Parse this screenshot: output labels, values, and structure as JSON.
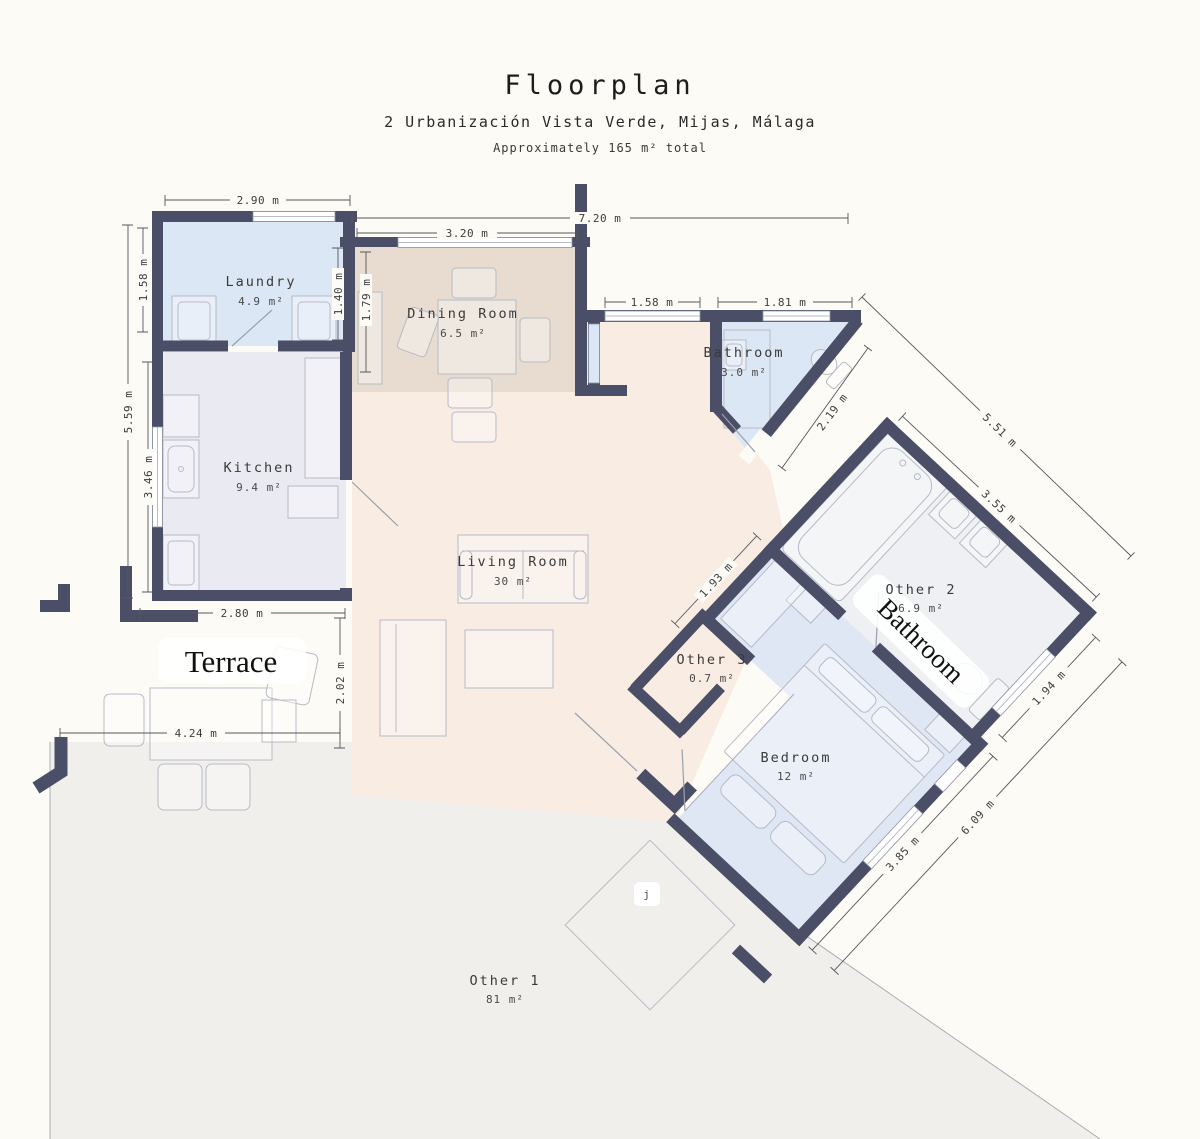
{
  "header": {
    "title": "Floorplan",
    "subtitle": "2 Urbanización Vista Verde, Mijas, Málaga",
    "note": "Approximately 165 m² total"
  },
  "rooms": {
    "laundry": {
      "name": "Laundry",
      "area": "4.9 m²"
    },
    "dining": {
      "name": "Dining Room",
      "area": "6.5 m²"
    },
    "kitchen": {
      "name": "Kitchen",
      "area": "9.4 m²"
    },
    "bathroom": {
      "name": "Bathroom",
      "area": "3.0 m²"
    },
    "living": {
      "name": "Living Room",
      "area": "30 m²"
    },
    "other2": {
      "name": "Other 2",
      "area": "6.9 m²"
    },
    "other3": {
      "name": "Other 3",
      "area": "0.7 m²"
    },
    "bedroom": {
      "name": "Bedroom",
      "area": "12 m²"
    },
    "other1": {
      "name": "Other 1",
      "area": "81 m²"
    }
  },
  "labels": {
    "terrace": "Terrace",
    "bathroom_serif": "Bathroom",
    "marker_j": "j"
  },
  "dims": {
    "laundry_top": "2.90 m",
    "overall_top": "7.20 m",
    "dining_top": "3.20 m",
    "laundry_left": "1.58 m",
    "overall_left": "5.59 m",
    "kitchen_left": "3.46 m",
    "laundry_right": "1.40 m",
    "dining_left": "1.79 m",
    "hall_window": "1.58 m",
    "bath_window": "1.81 m",
    "bath_diag": "2.19 m",
    "right_diag": "5.51 m",
    "other2_nw": "1.93 m",
    "other2_ne": "3.55 m",
    "other2_se": "1.94 m",
    "kitchen_bottom": "2.80 m",
    "terrace_right": "2.02 m",
    "terrace_bottom": "4.24 m",
    "bedroom_se": "3.85 m",
    "bedroom_se_overall": "6.09 m"
  },
  "colors": {
    "background": "#fdfbf5",
    "wall": "#4a4e66",
    "room_blue": "#dce7f5",
    "room_tan": "#e7dccf",
    "room_lavender": "#eaeaf3",
    "room_peach": "#f8ece3",
    "room_gray": "#f0efec",
    "room_bedroom": "#dfe6f4"
  }
}
